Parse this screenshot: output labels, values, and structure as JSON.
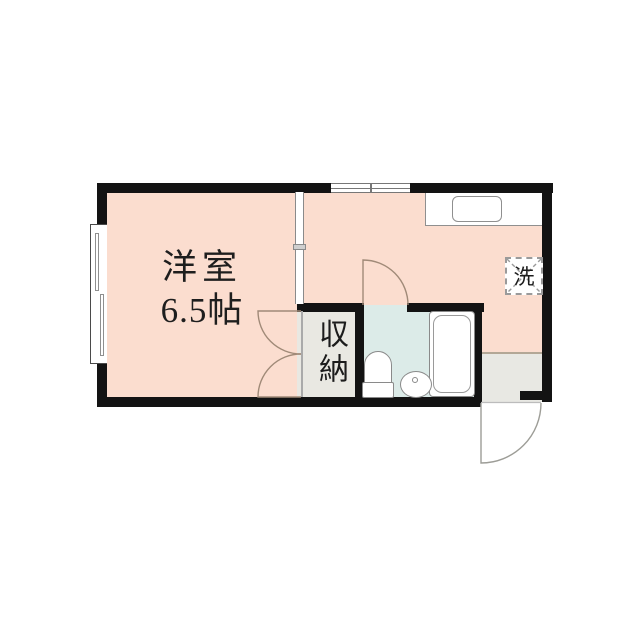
{
  "floor_plan": {
    "western_room": {
      "label": "洋室",
      "area": "6.5帖"
    },
    "closet": {
      "label": "収納"
    },
    "laundry": {
      "label": "洗"
    },
    "colors": {
      "floor": "#fbddcf",
      "bathroom_floor": "#dcebe8",
      "closet_floor": "#e9e8e2",
      "entry_floor": "#e8e8e3",
      "wall": "#131313",
      "door_swing": "#a08a78",
      "fixture_outline": "#8a8a8a"
    }
  }
}
